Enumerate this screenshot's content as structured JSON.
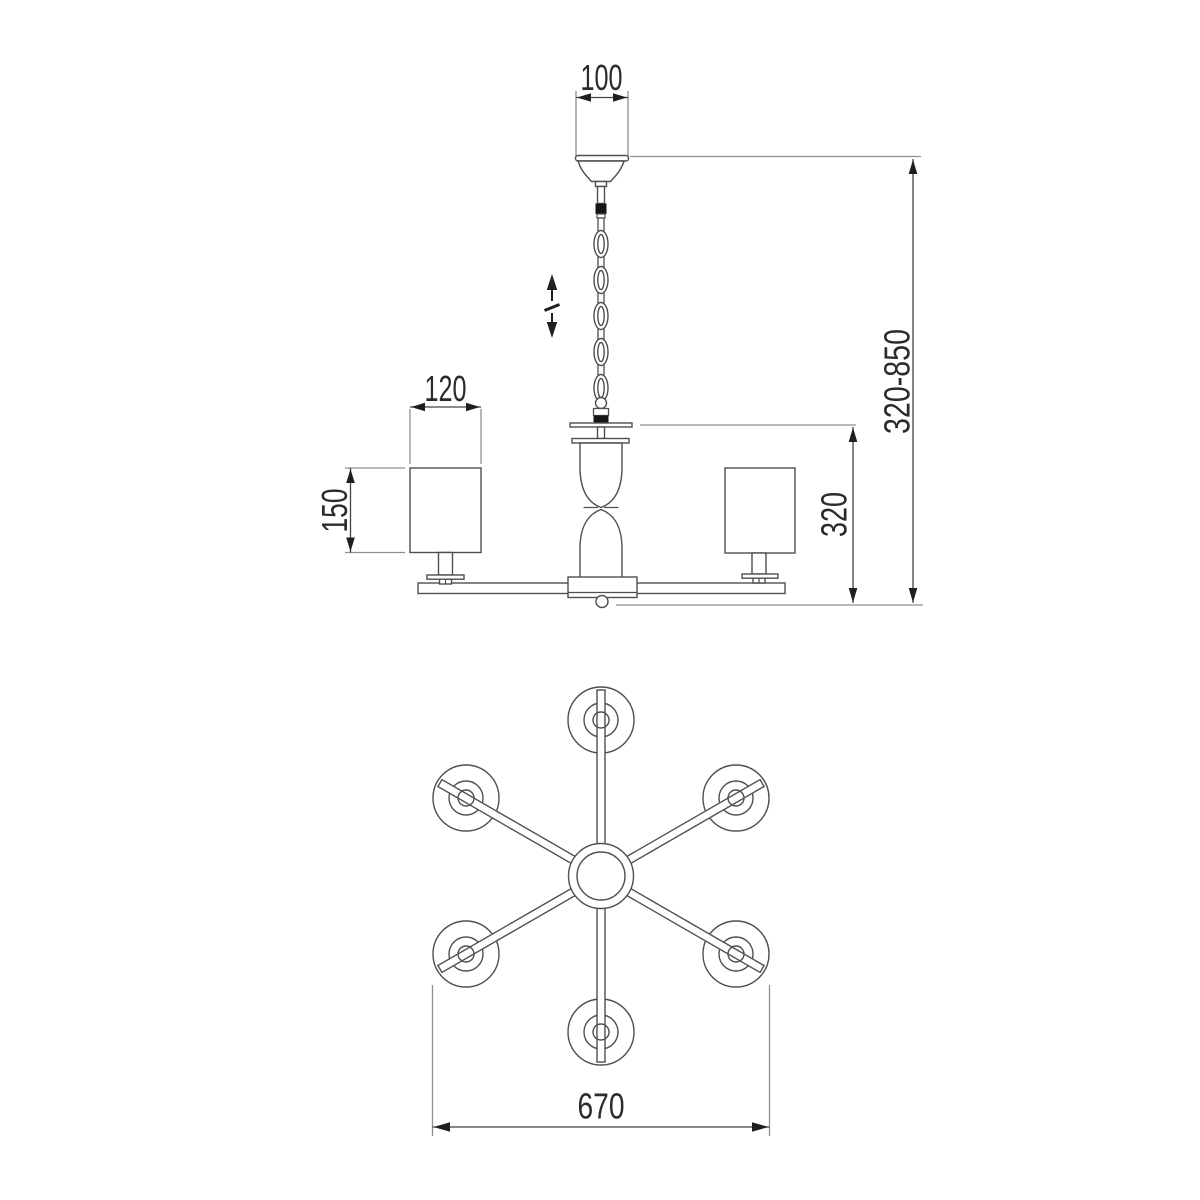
{
  "canvas": {
    "width": 1200,
    "height": 1200,
    "background": "#ffffff"
  },
  "colors": {
    "object_line": "#4f4f4f",
    "extension_line": "#8f8f8f",
    "dimension_line": "#454545",
    "arrow": "#1f1f1f",
    "text": "#2b2b2b",
    "connector_black": "#161616",
    "fill": "#ffffff"
  },
  "dims": {
    "canopy_width": "100",
    "shade_diameter": "120",
    "shade_height": "150",
    "body_height": "320",
    "height_range": "320-850",
    "overall_diameter": "670"
  },
  "front_view": {
    "chain_link_count": 5,
    "visible_shade_count": 2,
    "has_height_adjustment_indicator": true
  },
  "plan_view": {
    "arm_count": 6,
    "shade_count": 6
  }
}
